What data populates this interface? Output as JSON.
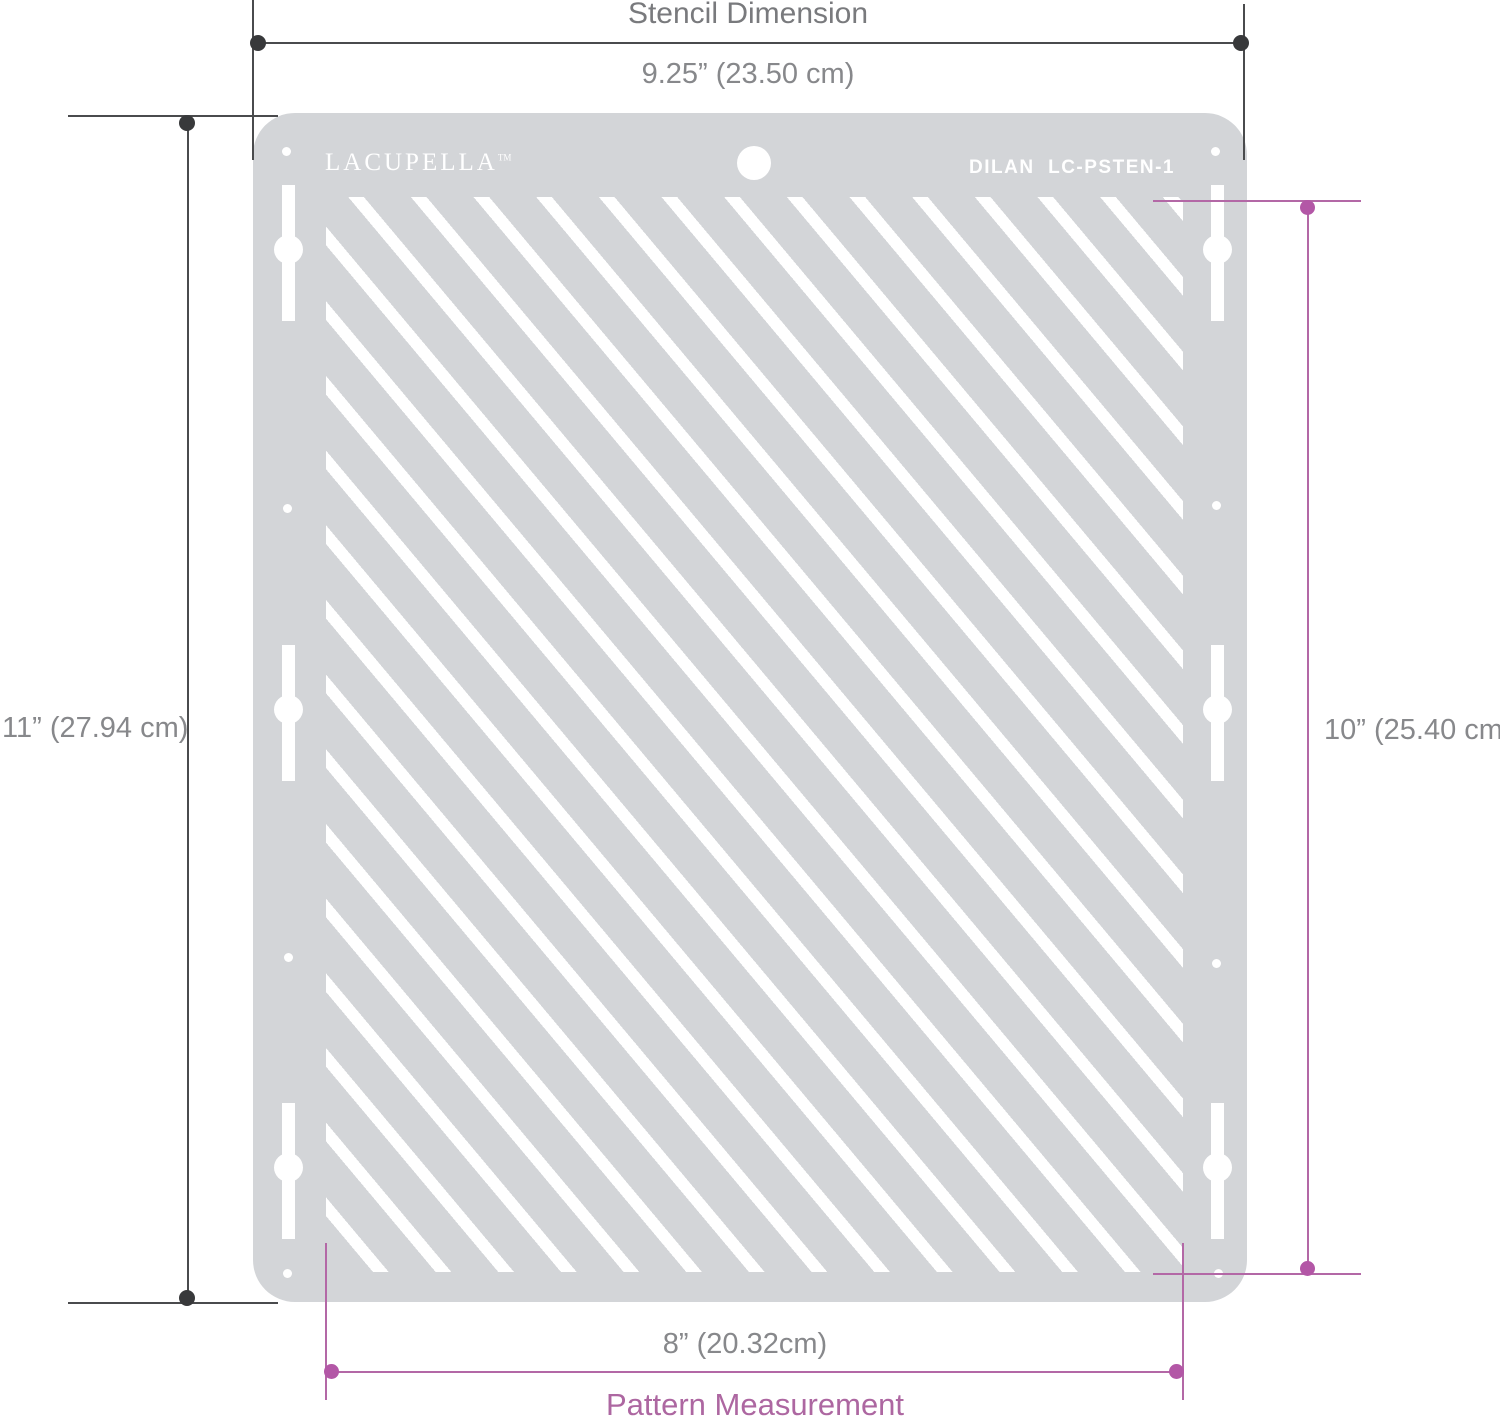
{
  "diagram": {
    "top": {
      "title": "Stencil Dimension",
      "width_label": "9.25” (23.50 cm)"
    },
    "left": {
      "height_label": "11” (27.94 cm)"
    },
    "right": {
      "height_label": "10” (25.40 cm)"
    },
    "bottom": {
      "width_label": "8” (20.32cm)",
      "title": "Pattern Measurement"
    },
    "colors": {
      "dimension_line": "#4a4b4d",
      "dimension_dot": "#38393b",
      "dimension_text": "#87888b",
      "accent_pink_line": "#b368a6",
      "accent_pink_text": "#ad67a1"
    }
  },
  "stencil": {
    "brand": "LACUPELLA",
    "brand_mark": "TM",
    "model": "DILAN  LC-PSTEN-1",
    "colors": {
      "plate": "#d3d5d8",
      "cutout": "#ffffff"
    }
  }
}
